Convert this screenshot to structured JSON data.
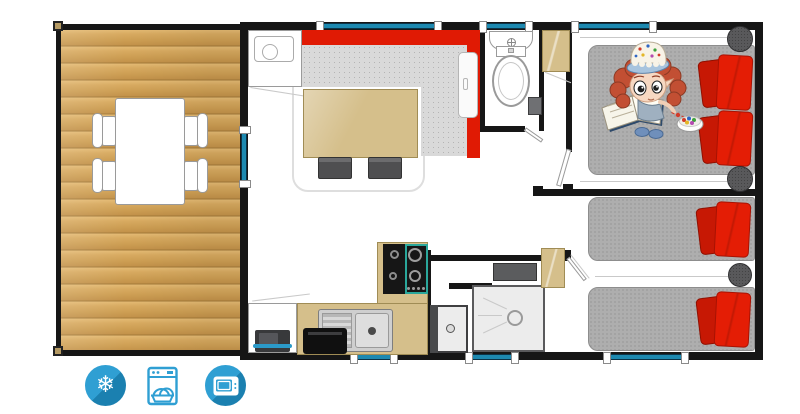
{
  "app": {
    "name": "mobile-home-floor-plan"
  },
  "canvas": {
    "width": 800,
    "height": 414
  },
  "colors": {
    "wall": "#161616",
    "window_glass": "#1d89b0",
    "terrace_wood": "#d2a45c",
    "sofa_red": "#e01a04",
    "pillow_red": "#e41d05",
    "pillow_red_shadow": "#c71804",
    "fabric_gray": "#aeaeae",
    "furniture_tan": "#d5bf8b",
    "hob_teal": "#2aa79b",
    "icon_blue": "#2f9fd3",
    "icon_blue_shadow": "#1b80b0"
  },
  "amenities": [
    {
      "name": "air-conditioning",
      "icon": "snowflake-icon",
      "glyph": "❄"
    },
    {
      "name": "dishwasher",
      "icon": "dishwasher-icon"
    },
    {
      "name": "television",
      "icon": "tv-icon"
    }
  ]
}
